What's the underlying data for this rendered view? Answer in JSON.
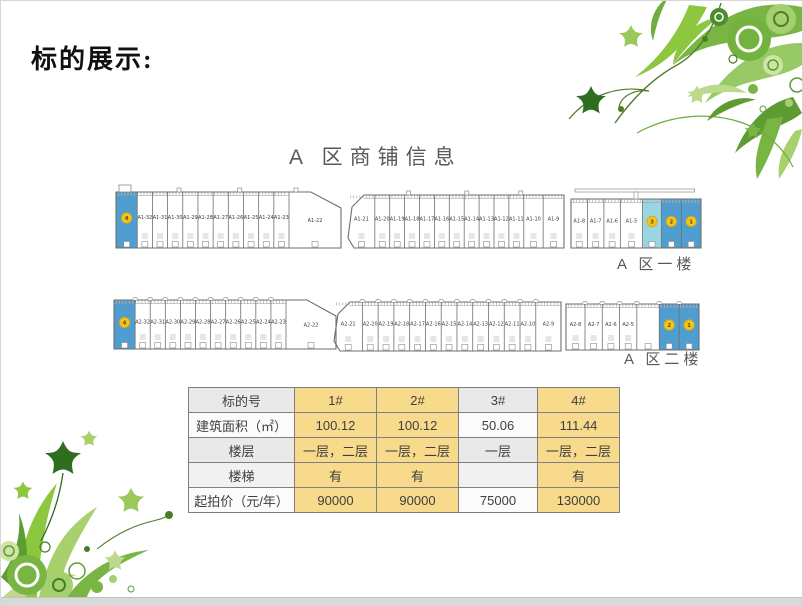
{
  "slide": {
    "title": "标的展示:",
    "section_heading": "A 区商铺信息"
  },
  "floorplan": {
    "floor1": {
      "label": "A 区一楼",
      "buildings": [
        {
          "units": [
            {
              "c": "4",
              "f": "dark",
              "w": 1.4
            },
            {
              "t": "A1-32"
            },
            {
              "t": "A1-31"
            },
            {
              "t": "A1-30"
            },
            {
              "t": "A1-29"
            },
            {
              "t": "A1-28"
            },
            {
              "t": "A1-27"
            },
            {
              "t": "A1-26"
            },
            {
              "t": "A1-25"
            },
            {
              "t": "A1-24"
            },
            {
              "t": "A1-23"
            }
          ],
          "angled_unit": {
            "t": "A1-22"
          }
        },
        {
          "units": [
            {
              "t": "A1-21",
              "w": 1.8
            },
            {
              "t": "A1-20"
            },
            {
              "t": "A1-19"
            },
            {
              "t": "A1-18"
            },
            {
              "t": "A1-17"
            },
            {
              "t": "A1-16"
            },
            {
              "t": "A1-15"
            },
            {
              "t": "A1-14"
            },
            {
              "t": "A1-13"
            },
            {
              "t": "A1-12"
            },
            {
              "t": "A1-11"
            },
            {
              "t": "A1-10",
              "w": 1.3
            },
            {
              "t": "A1-9",
              "w": 1.4
            }
          ]
        },
        {
          "units": [
            {
              "t": "A1-8"
            },
            {
              "t": "A1-7"
            },
            {
              "t": "A1-6"
            },
            {
              "t": "A1-5",
              "w": 1.35
            },
            {
              "c": "3",
              "f": "light",
              "w": 1.15
            },
            {
              "c": "2",
              "f": "dark",
              "w": 1.2
            },
            {
              "c": "1",
              "f": "dark",
              "w": 1.2
            }
          ]
        }
      ]
    },
    "floor2": {
      "label": "A 区二楼",
      "buildings": [
        {
          "units": [
            {
              "c": "4",
              "f": "dark",
              "w": 1.4
            },
            {
              "t": "A2-32"
            },
            {
              "t": "A2-31"
            },
            {
              "t": "A2-30"
            },
            {
              "t": "A2-29"
            },
            {
              "t": "A2-28"
            },
            {
              "t": "A2-27"
            },
            {
              "t": "A2-26"
            },
            {
              "t": "A2-25"
            },
            {
              "t": "A2-24"
            },
            {
              "t": "A2-23"
            }
          ],
          "angled_unit": {
            "t": "A2-22"
          }
        },
        {
          "units": [
            {
              "t": "A2-21",
              "w": 1.8
            },
            {
              "t": "A2-20"
            },
            {
              "t": "A2-19"
            },
            {
              "t": "A2-18"
            },
            {
              "t": "A2-17"
            },
            {
              "t": "A2-16"
            },
            {
              "t": "A2-15"
            },
            {
              "t": "A2-14"
            },
            {
              "t": "A2-13"
            },
            {
              "t": "A2-12"
            },
            {
              "t": "A2-11"
            },
            {
              "t": "A2-10"
            },
            {
              "t": "A2-9",
              "w": 1.6
            }
          ]
        },
        {
          "units": [
            {
              "t": "A2-8",
              "w": 1.1
            },
            {
              "t": "A2-7"
            },
            {
              "t": "A2-6"
            },
            {
              "t": "A2-5"
            },
            {
              "t": "",
              "w": 1.3
            },
            {
              "c": "2",
              "f": "dark",
              "w": 1.15
            },
            {
              "c": "1",
              "f": "dark",
              "w": 1.15
            }
          ]
        }
      ]
    }
  },
  "table": {
    "header": [
      "标的号",
      "1#",
      "2#",
      "3#",
      "4#"
    ],
    "rows": [
      {
        "label": "建筑面积（㎡）",
        "values": [
          "100.12",
          "100.12",
          "50.06",
          "111.44"
        ]
      },
      {
        "label": "楼层",
        "values": [
          "一层，二层",
          "一层，二层",
          "一层",
          "一层，二层"
        ]
      },
      {
        "label": "楼梯",
        "values": [
          "有",
          "有",
          "",
          "有"
        ]
      },
      {
        "label": "起拍价（元/年）",
        "values": [
          "90000",
          "90000",
          "75000",
          "130000"
        ]
      }
    ],
    "highlight_columns": [
      1,
      2,
      4
    ],
    "colors": {
      "highlight": "#f7da8b",
      "band_gray": "#e9e9e9",
      "border": "#7f7f7f"
    }
  },
  "colors": {
    "unit_blue": "#4f9ecf",
    "unit_blue_light": "#9ad5e2",
    "lot_circle": "#f2c41c",
    "heading_gray": "#595959",
    "accent_green": "#79b543"
  }
}
